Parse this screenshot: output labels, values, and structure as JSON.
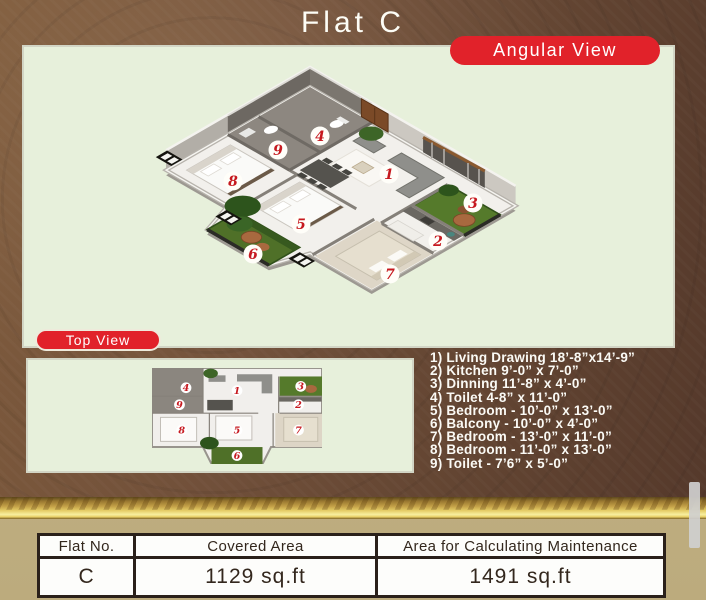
{
  "title": "Flat C",
  "badges": {
    "angular": "Angular View",
    "top": "Top View"
  },
  "legend": {
    "items": [
      "1) Living Drawing 18’-8”x14’-9”",
      "2) Kitchen 9’-0” x 7’-0”",
      "3) Dinning 11’-8” x 4’-0”",
      "4) Toilet 4-8” x 11’-0”",
      "5) Bedroom - 10’-0” x 13’-0”",
      "6) Balcony - 10’-0” x 4’-0”",
      "7) Bedroom - 13’-0” x 11’-0”",
      "8) Bedroom - 11’-0” x 13’-0”",
      "9) Toilet - 7’6” x 5’-0”"
    ]
  },
  "markers": {
    "m1": "1",
    "m2": "2",
    "m3": "3",
    "m4": "4",
    "m5": "5",
    "m6": "6",
    "m7": "7",
    "m8": "8",
    "m9": "9"
  },
  "table": {
    "headers": [
      "Flat No.",
      "Covered Area",
      "Area for Calculating Maintenance"
    ],
    "row": {
      "flat_no": "C",
      "covered_area": "1129 sq.ft",
      "maintenance_area": "1491 sq.ft"
    }
  },
  "colors": {
    "badge_red": "#e1222a",
    "panel_green": "#e7f0db",
    "brown_bg": "#6e4c36",
    "gold_band": "#d9b959",
    "tan_bg": "#bfae80",
    "marker_red": "#c6191f"
  }
}
